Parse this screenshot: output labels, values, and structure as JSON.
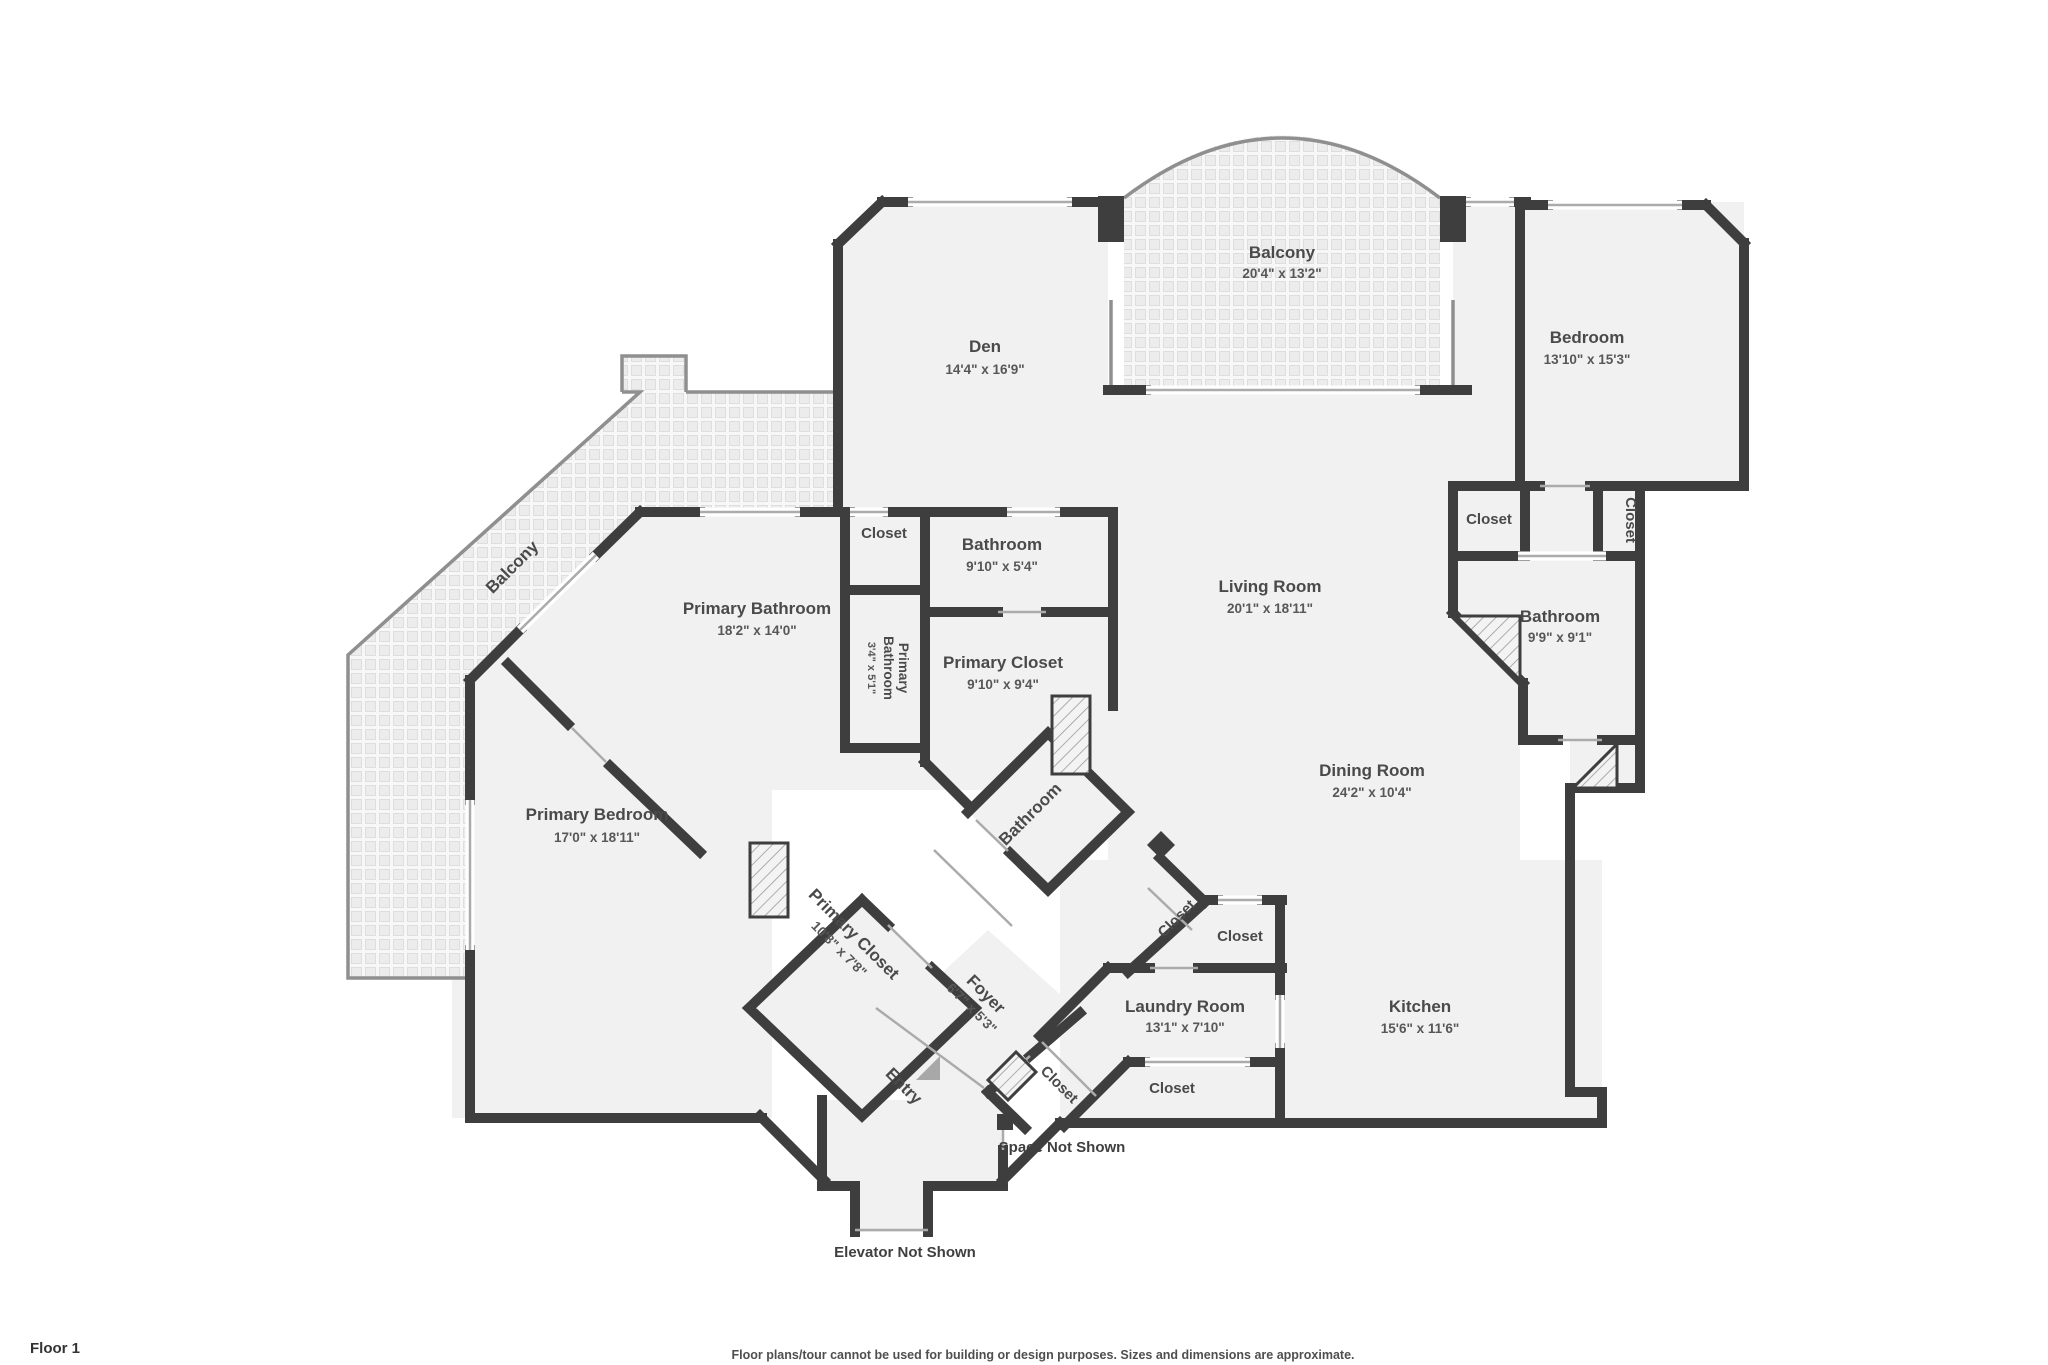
{
  "rooms": {
    "balcony_top": {
      "name": "Balcony",
      "dims": "20'4\" x 13'2\""
    },
    "den": {
      "name": "Den",
      "dims": "14'4\" x 16'9\""
    },
    "bedroom": {
      "name": "Bedroom",
      "dims": "13'10\" x 15'3\""
    },
    "living": {
      "name": "Living Room",
      "dims": "20'1\" x 18'11\""
    },
    "dining": {
      "name": "Dining Room",
      "dims": "24'2\" x 10'4\""
    },
    "kitchen": {
      "name": "Kitchen",
      "dims": "15'6\" x 11'6\""
    },
    "laundry": {
      "name": "Laundry Room",
      "dims": "13'1\" x 7'10\""
    },
    "bathroom_east": {
      "name": "Bathroom",
      "dims": "9'9\" x 9'1\""
    },
    "bathroom_hall": {
      "name": "Bathroom",
      "dims": "9'10\" x 5'4\""
    },
    "primary_bathroom": {
      "name": "Primary Bathroom",
      "dims": "18'2\" x 14'0\""
    },
    "primary_bathroom_small": {
      "line1": "Primary",
      "line2": "Bathroom",
      "dims": "3'4\" x 5'1\""
    },
    "primary_closet": {
      "name": "Primary Closet",
      "dims": "9'10\" x 9'4\""
    },
    "primary_closet_diag": {
      "name": "Primary Closet",
      "dims": "10'8\" x 7'8\""
    },
    "primary_bedroom": {
      "name": "Primary Bedroom",
      "dims": "17'0\" x 18'11\""
    },
    "balcony_left": {
      "name": "Balcony"
    },
    "bathroom_diag": {
      "name": "Bathroom"
    },
    "foyer": {
      "name": "Foyer",
      "dims": "6'7\" x 5'3\""
    },
    "entry": {
      "name": "Entry"
    },
    "closet_hall": {
      "name": "Closet"
    },
    "closet_bedroom_a": {
      "name": "Closet"
    },
    "closet_bedroom_b": {
      "name": "Closet"
    },
    "closet_laundry_nw": {
      "name": "Closet"
    },
    "closet_laundry_n": {
      "name": "Closet"
    },
    "closet_laundry_s": {
      "name": "Closet"
    },
    "closet_entry": {
      "name": "Closet"
    }
  },
  "annotations": {
    "space_not_shown": "Space Not Shown",
    "elevator_not_shown": "Elevator Not Shown"
  },
  "footer": {
    "floor_label": "Floor 1",
    "disclaimer": "Floor plans/tour cannot be used for building or design purposes. Sizes and dimensions are approximate."
  },
  "palette": {
    "wall": "#3e3e3e",
    "floor": "#f1f1f1",
    "label_text": "#4a4a4a",
    "balcony_tile": "#ececec",
    "hatch": "#9a9a9a",
    "entry_arrow": "#a8a8a8"
  }
}
